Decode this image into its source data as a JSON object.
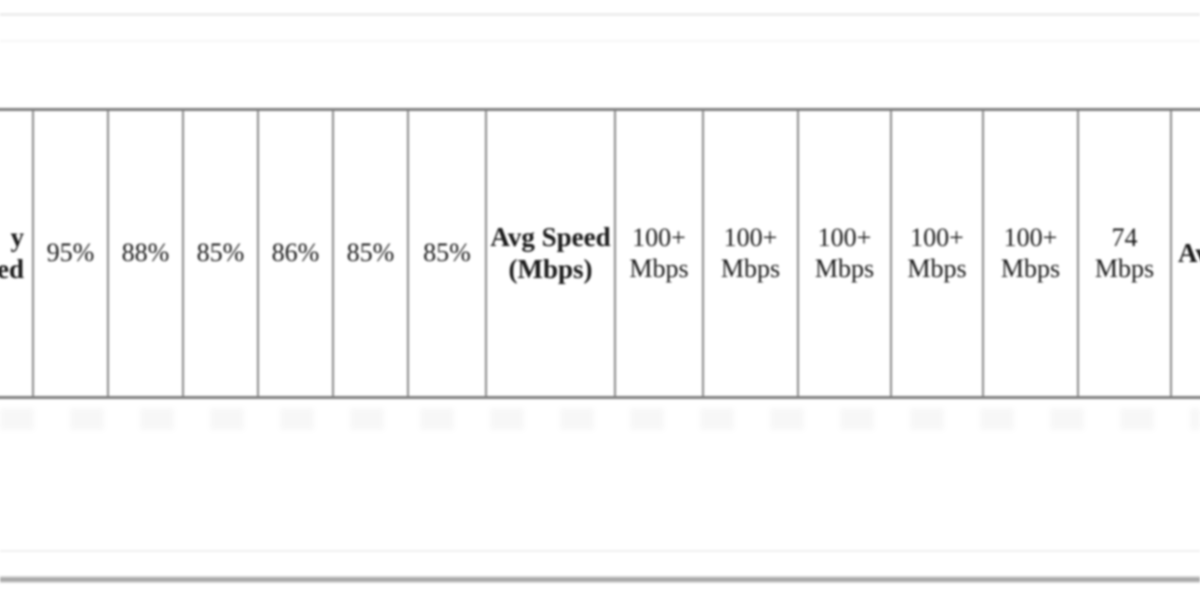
{
  "table": {
    "left_partial": {
      "line1": "y",
      "line2": "ed"
    },
    "percent_values": [
      "95%",
      "88%",
      "85%",
      "86%",
      "85%",
      "85%"
    ],
    "speed_header": "Avg Speed (Mbps)",
    "speed_values": [
      "100+ Mbps",
      "100+ Mbps",
      "100+ Mbps",
      "100+ Mbps",
      "100+ Mbps",
      "74 Mbps"
    ],
    "right_partial": "Av"
  },
  "colors": {
    "border_gray": "#8a8a8a",
    "row_border_gray": "#7f7f7f",
    "text": "#1a1a1a",
    "bottom_rule_gray": "#a0a0a0",
    "faint_rule_gray": "#ededed"
  }
}
